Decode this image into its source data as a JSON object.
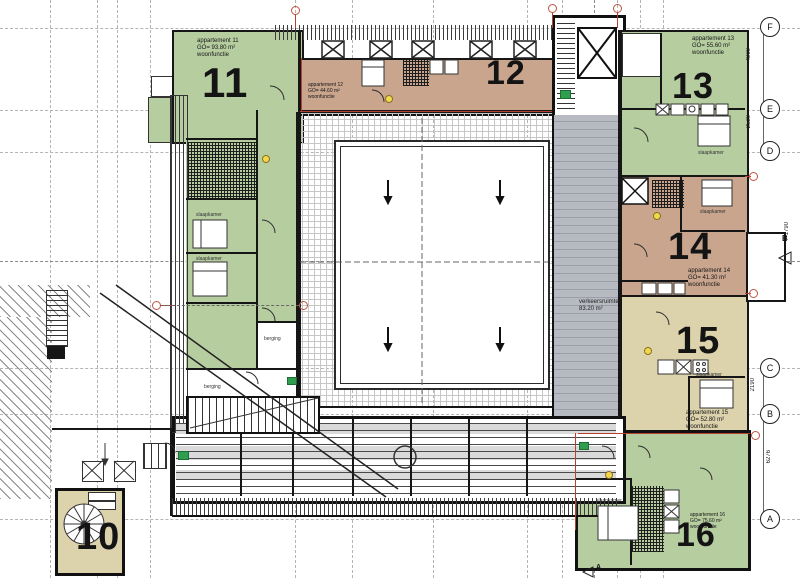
{
  "apartments": [
    {
      "num": "10",
      "label": "",
      "area": "",
      "func": ""
    },
    {
      "num": "11",
      "label": "appartement 11",
      "area": "GO= 93.80 m²",
      "func": "woonfunctie"
    },
    {
      "num": "12",
      "label": "appartement 12",
      "area": "GO= 44.60 m²",
      "func": "woonfunctie"
    },
    {
      "num": "13",
      "label": "appartement 13",
      "area": "GO= 55.60 m²",
      "func": "woonfunctie"
    },
    {
      "num": "14",
      "label": "appartement 14",
      "area": "GO= 41.30 m²",
      "func": "woonfunctie"
    },
    {
      "num": "15",
      "label": "appartement 15",
      "area": "GO= 52.80 m²",
      "func": "woonfunctie"
    },
    {
      "num": "16",
      "label": "appartement 16",
      "area": "GO= 75.60 m²",
      "func": "woonfunctie"
    }
  ],
  "corridor": {
    "label": "verkeersruimte",
    "area": "83.20 m²"
  },
  "rooms": {
    "bedroom": "slaapkamer",
    "storage": "berging"
  },
  "grid": {
    "markers": [
      "F",
      "E",
      "D",
      "C",
      "B",
      "A"
    ],
    "section_right": "B",
    "section_bottom": "A",
    "dims": {
      "f_e": "4900",
      "e_d": "2520",
      "d_b": "1790",
      "c_b": "2190",
      "b_a": "6276"
    }
  },
  "colors": {
    "green": "#b6cda0",
    "tan": "#c9a58e",
    "cream": "#dcd2ac",
    "corridor_gray": "#b7bbc1",
    "marker_red": "#c0543f",
    "exit_green": "#2f9e4f"
  }
}
